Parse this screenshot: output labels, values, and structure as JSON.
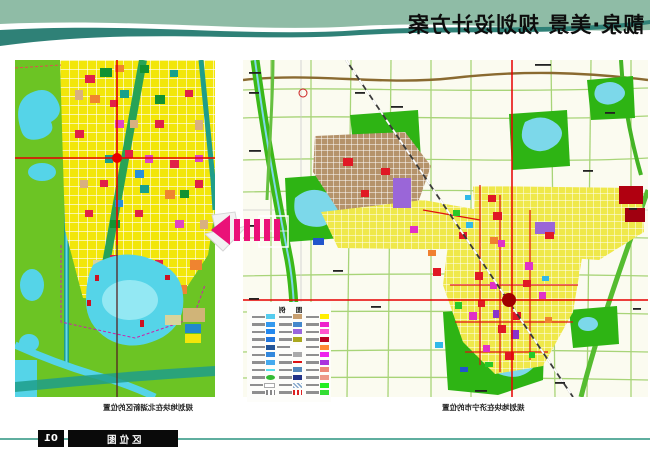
{
  "header": {
    "title": "靓泉·美景 规划设计方案",
    "band_color": "#8fbca6",
    "wave_color": "#2f8177"
  },
  "left_map": {
    "caption": "规划地块在北湖新区的位置",
    "colors": {
      "background_green": "#6cc424",
      "water": "#55d4e8",
      "parcel_yellow": "#f2e60a",
      "canal_teal": "#1f9e8a",
      "crosshair_red": "#e80000"
    }
  },
  "right_map": {
    "caption": "规划地块在济宁市的位置",
    "colors": {
      "background": "#fbfbf0",
      "road_green": "#a8d478",
      "old_town_brown": "#b5936b",
      "urban_yellow": "#efe84a",
      "park_green": "#2eb414",
      "lake": "#7cd8ea",
      "highway_brown": "#8a6a30",
      "railway": "#3a3a3a",
      "crosshair_red": "#e80000",
      "target_dot": "#a00000"
    },
    "legend": {
      "title": "图 例",
      "rows": [
        [
          "#55ccee",
          "#c8a070",
          "#ffee00"
        ],
        [
          "#3399ee",
          "#4488cc",
          "#ee22cc"
        ],
        [
          "#2288ee",
          "#9966dd",
          "#ff55cc"
        ],
        [
          "#2277dd",
          "#aaa820",
          "#bb0022"
        ],
        [
          "#225599",
          "outline|#ffffff",
          "#ff8833"
        ],
        [
          "#3388dd",
          "#aaaaaa",
          "#ee22ee"
        ],
        [
          "#44aaee",
          "line|#dd1111",
          "#aa33dd"
        ],
        [
          "line|#55ddee",
          "#5588bb",
          "#ee8877"
        ],
        [
          "oval|#33bb33",
          "#223388",
          "#ee9988"
        ],
        [
          "outline|#aaaaaa",
          "hatch|#88aacc",
          "#22ee22"
        ],
        [
          "dash|#888888",
          "dash|#dd2222",
          "#33dd33"
        ]
      ]
    }
  },
  "arrow": {
    "color": "#ea1178"
  },
  "footer": {
    "page_number": "01",
    "section_label": "区位图",
    "line_color": "#5fae9f"
  }
}
